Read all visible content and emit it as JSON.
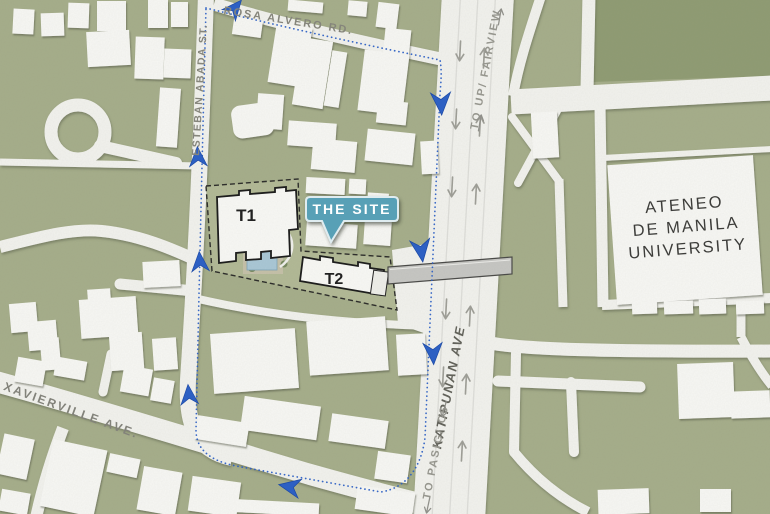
{
  "map": {
    "road_labels": {
      "rosa_alvero": "ROSA ALVERO RD.",
      "esteban_abada": "ESTEBAN ABADA ST.",
      "katipunan": "KATIPUNAN AVE",
      "xavierville": "XAVIERVILLE AVE.",
      "to_up_fairview": "TO UP/ FAIRVIEW",
      "to_pasig_c5": "TO PASIG/ C5"
    },
    "site": {
      "callout_label": "THE SITE",
      "tower1_label": "T1",
      "tower2_label": "T2"
    },
    "landmarks": {
      "ateneo": {
        "line1": "ATENEO",
        "line2": "DE MANILA",
        "line3": "UNIVERSITY"
      }
    },
    "icons": {
      "route_chevron": "blue directional route chevron arrow",
      "lane_arrow": "gray lane direction arrow",
      "footbridge": "gray pedestrian footbridge bar"
    },
    "colors": {
      "map_green": "#a6ae8b",
      "campus_green_dark": "#909c74",
      "road_white": "#f2f2ee",
      "building_white": "#f7f7f4",
      "route_blue": "#2d60c3",
      "callout_teal": "#58a0b6",
      "pool_blue": "#a9c7d6",
      "label_gray": "#85857b",
      "building_outline": "#1b1b1b",
      "lane_arrow_gray": "#9f9f98"
    }
  }
}
